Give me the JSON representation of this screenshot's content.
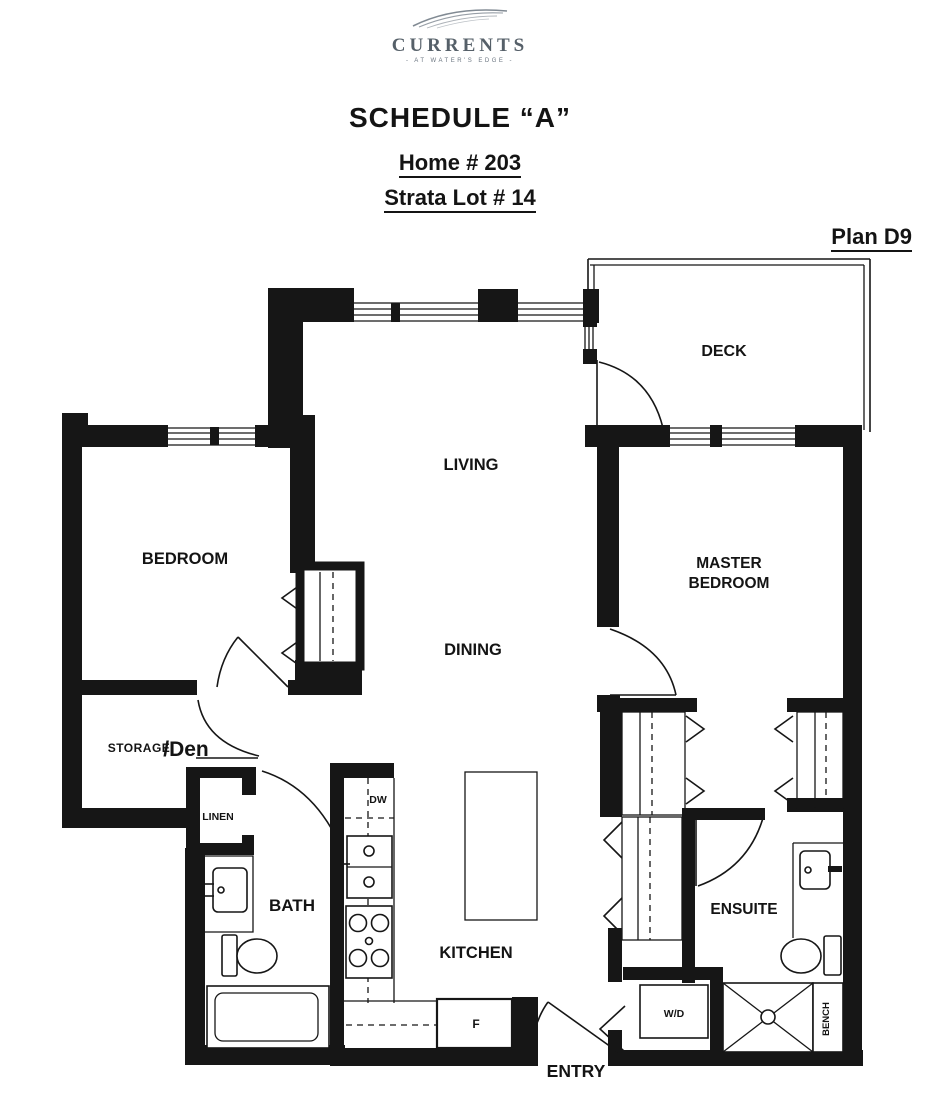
{
  "colors": {
    "ink": "#161616",
    "paper": "#ffffff",
    "logo_gray": "#5d6772"
  },
  "logo": {
    "name": "CURRENTS",
    "tagline": "- AT WATER'S EDGE -"
  },
  "header": {
    "title": "SCHEDULE “A”",
    "home": "Home # 203",
    "strata": "Strata Lot # 14",
    "plan": "Plan D9"
  },
  "rooms": {
    "deck": "DECK",
    "living": "LIVING",
    "dining": "DINING",
    "bedroom": "BEDROOM",
    "master_line1": "MASTER",
    "master_line2": "BEDROOM",
    "storage": "STORAGE",
    "den": "/Den",
    "linen": "LINEN",
    "bath": "BATH",
    "kitchen": "KITCHEN",
    "ensuite": "ENSUITE",
    "entry": "ENTRY"
  },
  "appliances": {
    "dishwasher": "DW",
    "washer_dryer": "W/D",
    "fridge": "F",
    "bench": "BENCH"
  }
}
